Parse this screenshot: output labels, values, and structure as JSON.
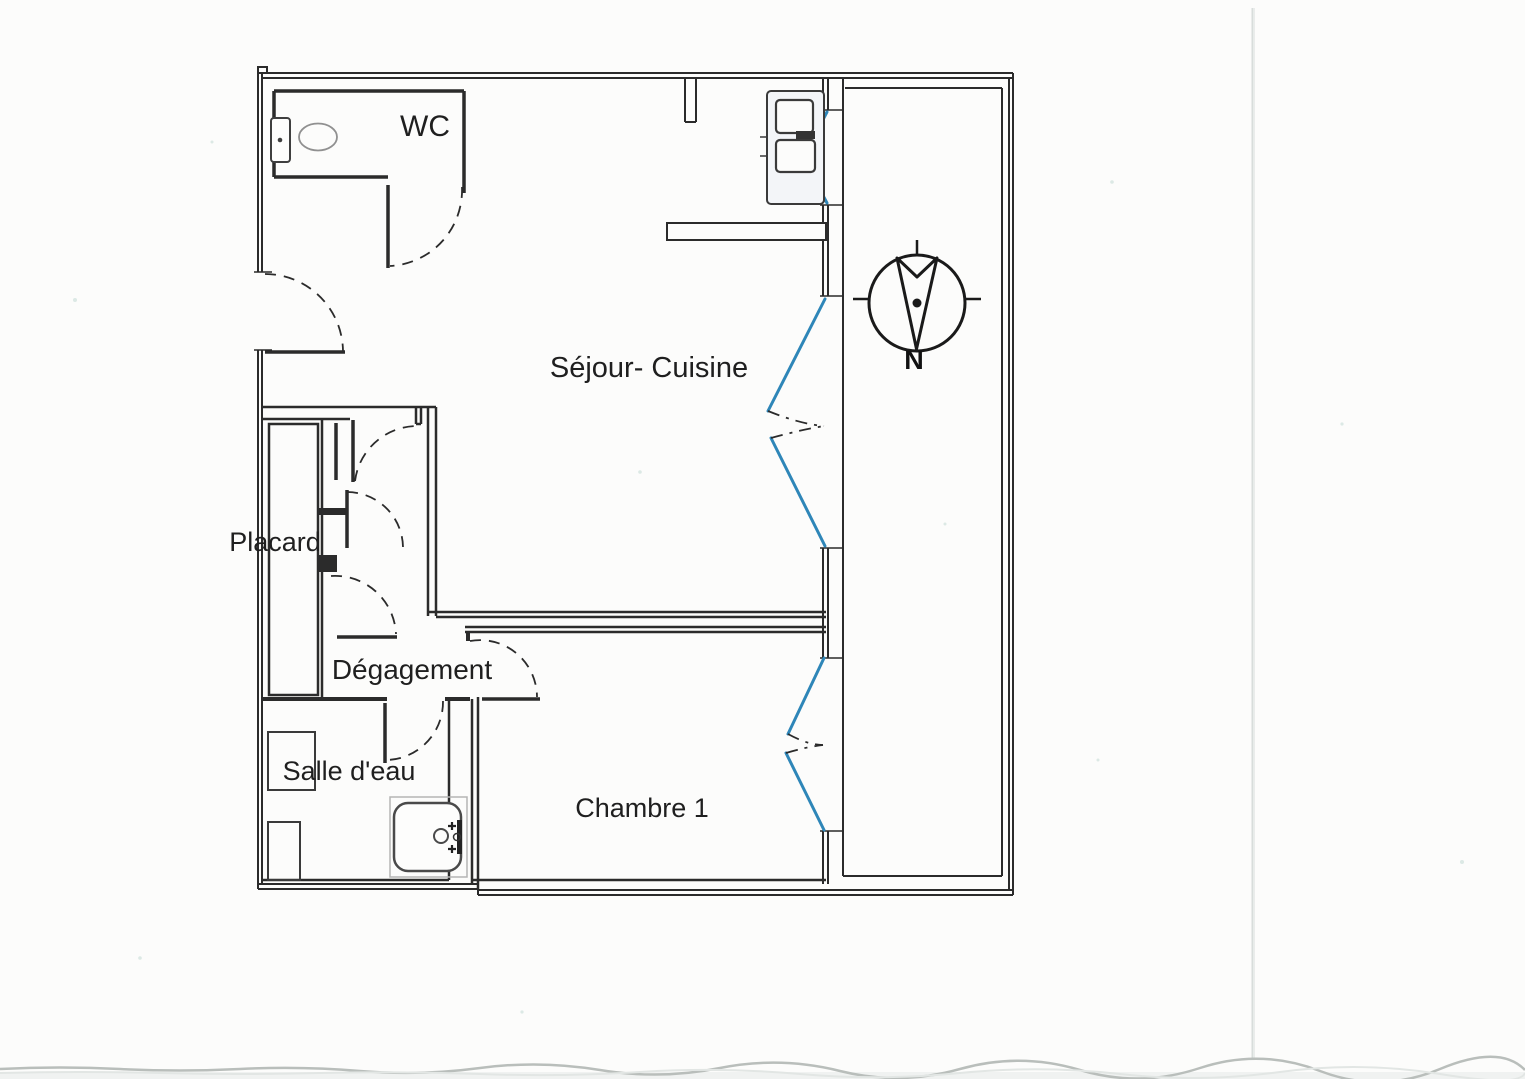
{
  "rooms": [
    {
      "name": "wc",
      "label": "WC"
    },
    {
      "name": "sejour-cuisine",
      "label": "Séjour- Cuisine"
    },
    {
      "name": "placard",
      "label": "Placard"
    },
    {
      "name": "degagement",
      "label": "Dégagement"
    },
    {
      "name": "salle-deau",
      "label": "Salle d'eau"
    },
    {
      "name": "chambre-1",
      "label": "Chambre 1"
    }
  ],
  "compass": {
    "north_label": "N"
  },
  "colors": {
    "wall": "#2b2b2b",
    "window_accent": "#2e86b8",
    "paper": "#fcfcfb",
    "scan_edge_line": "#b9bebb",
    "scan_fold_line": "#d8dddb"
  }
}
